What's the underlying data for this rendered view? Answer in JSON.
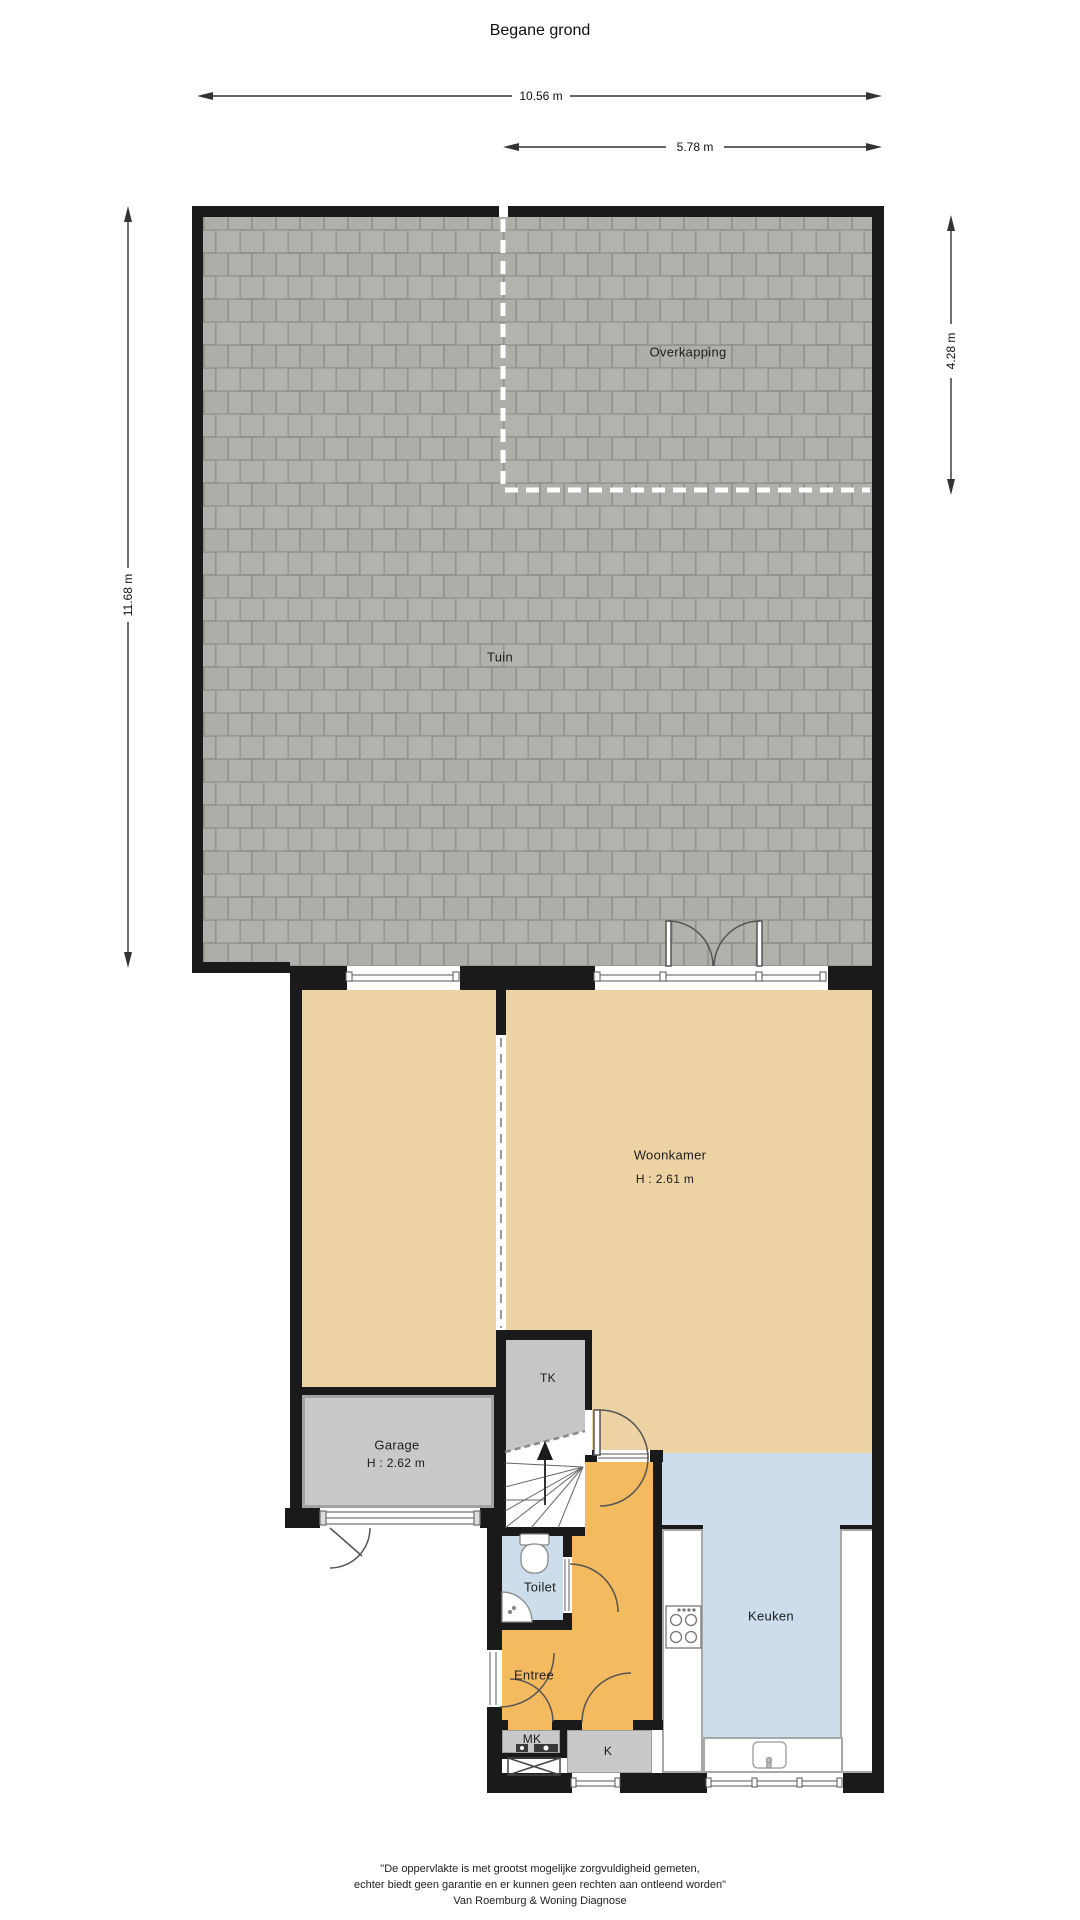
{
  "title": "Begane grond",
  "dimensions": {
    "total_width": "10.56 m",
    "overkapping_width": "5.78 m",
    "garden_height": "11.68 m",
    "overkapping_height": "4.28 m"
  },
  "rooms": {
    "tuin": {
      "label": "Tuin"
    },
    "overkapping": {
      "label": "Overkapping"
    },
    "woonkamer": {
      "label": "Woonkamer",
      "height": "H : 2.61 m"
    },
    "garage": {
      "label": "Garage",
      "height": "H : 2.62 m"
    },
    "tk": {
      "label": "TK"
    },
    "toilet": {
      "label": "Toilet"
    },
    "entree": {
      "label": "Entree"
    },
    "keuken": {
      "label": "Keuken"
    },
    "mk": {
      "label": "MK"
    },
    "k": {
      "label": "K"
    }
  },
  "footer": {
    "line1": "\"De oppervlakte is met grootst mogelijke zorgvuldigheid gemeten,",
    "line2": "echter biedt geen garantie en er kunnen geen rechten aan ontleend worden\"",
    "line3": "Van Roemburg & Woning Diagnose"
  },
  "colors": {
    "wall": "#1a1a1a",
    "tile": "#b0b0ac",
    "tile_joint": "#8f8f8b",
    "living_beige": "#edd3a4",
    "hall_orange": "#f3ba60",
    "kitchen_blue": "#cdddec",
    "closet_gray": "#c9c9c9"
  }
}
